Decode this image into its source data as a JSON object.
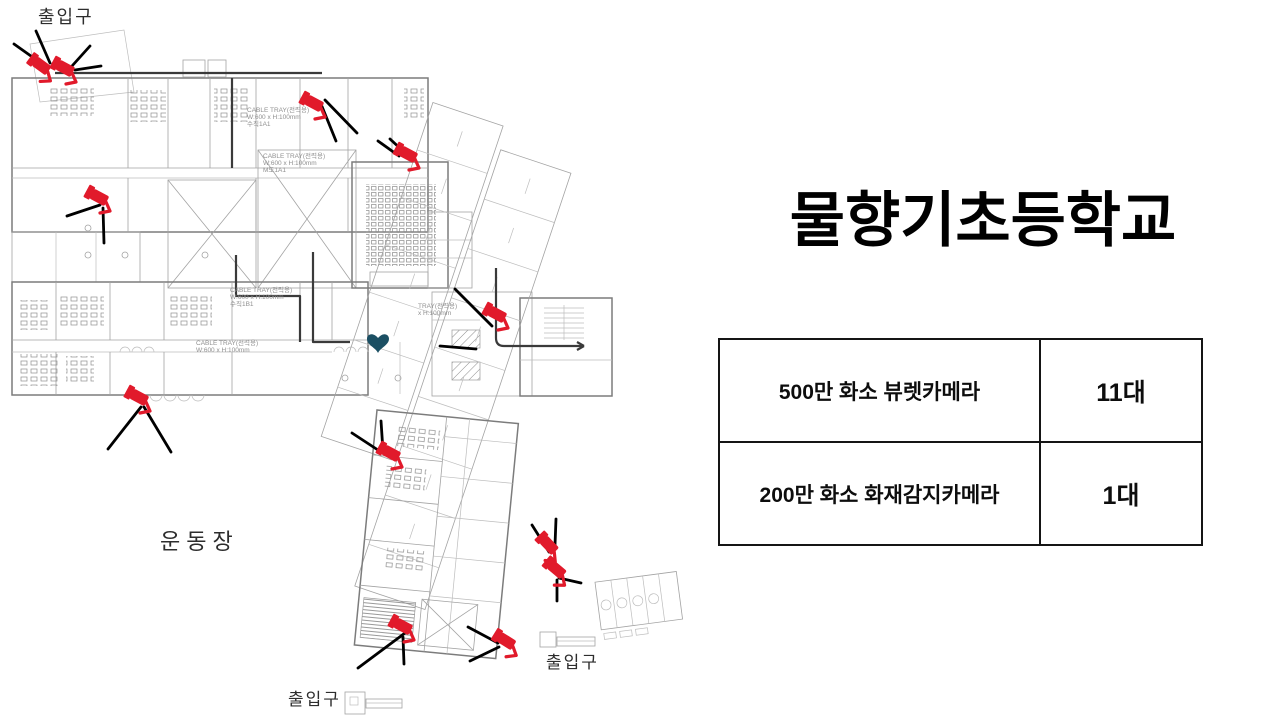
{
  "title": {
    "line1": "물향기초등학교",
    "line2": "CCTV  배치도"
  },
  "summary_table": {
    "rows": [
      {
        "label": "500만 화소 뷰렛카메라",
        "count": "11대"
      },
      {
        "label": "200만 화소 화재감지카메라",
        "count": "1대"
      }
    ]
  },
  "floor_plan": {
    "camera_color": "#e11a2b",
    "heart_color": "#1b4f63",
    "heart": {
      "x": 378,
      "y": 343
    },
    "labels": [
      {
        "id": "entrance-label-top",
        "text": "출입구",
        "x": 38,
        "y": 23,
        "size": 18,
        "spacing": 2
      },
      {
        "id": "playground-label",
        "text": "운동장",
        "x": 160,
        "y": 549,
        "size": 22,
        "spacing": 6
      },
      {
        "id": "entrance-label-bottom-right",
        "text": "출입구",
        "x": 546,
        "y": 668,
        "size": 17,
        "spacing": 2
      },
      {
        "id": "entrance-label-bottom-left",
        "text": "출입구",
        "x": 288,
        "y": 705,
        "size": 17,
        "spacing": 2
      }
    ],
    "annotations": [
      {
        "x": 247,
        "y": 112,
        "lines": [
          "CABLE TRAY(전력용)",
          "W:600 x H:100mm",
          "수직1A1"
        ]
      },
      {
        "x": 263,
        "y": 158,
        "lines": [
          "CABLE TRAY(전력용)",
          "W:600 x H:100mm",
          "M도1A1"
        ]
      },
      {
        "x": 230,
        "y": 292,
        "lines": [
          "CABLE TRAY(전력용)",
          "W:600 x H:100mm",
          "수직1B1"
        ]
      },
      {
        "x": 196,
        "y": 345,
        "lines": [
          "CABLE TRAY(전력용)",
          "W:600 x H:100mm"
        ]
      },
      {
        "x": 418,
        "y": 308,
        "lines": [
          "TRAY(전력용)",
          "x H:100mm"
        ]
      }
    ],
    "cameras": [
      {
        "x": 45,
        "y": 69,
        "r": 8
      },
      {
        "x": 69,
        "y": 71,
        "r": 0
      },
      {
        "x": 103,
        "y": 200,
        "r": 0
      },
      {
        "x": 318,
        "y": 106,
        "r": 0
      },
      {
        "x": 412,
        "y": 157,
        "r": 0
      },
      {
        "x": 501,
        "y": 317,
        "r": 0
      },
      {
        "x": 143,
        "y": 400,
        "r": 0
      },
      {
        "x": 395,
        "y": 456,
        "r": 0
      },
      {
        "x": 552,
        "y": 549,
        "r": 18
      },
      {
        "x": 560,
        "y": 573,
        "r": 12
      },
      {
        "x": 407,
        "y": 629,
        "r": 0
      },
      {
        "x": 510,
        "y": 644,
        "r": 4
      }
    ],
    "pointer_lines": [
      [
        45,
        66,
        14,
        44
      ],
      [
        50,
        63,
        36,
        31
      ],
      [
        72,
        66,
        90,
        46
      ],
      [
        75,
        70,
        101,
        66
      ],
      [
        100,
        205,
        67,
        216
      ],
      [
        103,
        208,
        104,
        243
      ],
      [
        325,
        100,
        357,
        133
      ],
      [
        321,
        104,
        336,
        141
      ],
      [
        378,
        141,
        399,
        156
      ],
      [
        390,
        139,
        403,
        151
      ],
      [
        455,
        289,
        492,
        326
      ],
      [
        440,
        346,
        476,
        349
      ],
      [
        141,
        407,
        108,
        449
      ],
      [
        144,
        407,
        171,
        452
      ],
      [
        352,
        433,
        381,
        452
      ],
      [
        381,
        421,
        383,
        451
      ],
      [
        532,
        525,
        549,
        552
      ],
      [
        556,
        519,
        555,
        545
      ],
      [
        559,
        578,
        581,
        583
      ],
      [
        557,
        580,
        557,
        601
      ],
      [
        405,
        633,
        358,
        668
      ],
      [
        403,
        637,
        404,
        664
      ],
      [
        468,
        627,
        498,
        643
      ],
      [
        470,
        661,
        499,
        647
      ]
    ]
  }
}
